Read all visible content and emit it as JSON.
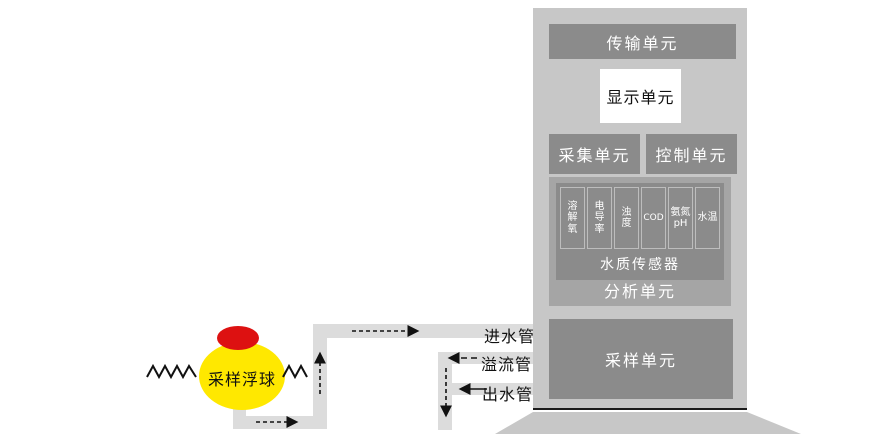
{
  "diagram_title": "水质自动监测系统示意图",
  "tower": {
    "transmission_label": "传输单元",
    "display_label": "显示单元",
    "collection_label": "采集单元",
    "control_label": "控制单元",
    "analysis": {
      "label": "分析单元",
      "sensor_bar_label": "水质传感器",
      "sensors": [
        "溶解氧",
        "电导率",
        "浊度",
        "COD",
        "氨氮 pH",
        "水温"
      ]
    },
    "sampling_label": "采样单元"
  },
  "float_ball": {
    "label": "采样浮球"
  },
  "pipes": {
    "inlet_label": "进水管",
    "overflow_label": "溢流管",
    "outlet_label": "出水管"
  },
  "colors": {
    "tower_body": "#c7c7c7",
    "unit_box": "#8b8b8b",
    "analysis_panel": "#a5a5a5",
    "pipe": "#dcdcdc",
    "float_yellow": "#ffe800",
    "float_cap_red": "#dd1111",
    "ink": "#111111",
    "white": "#ffffff"
  }
}
